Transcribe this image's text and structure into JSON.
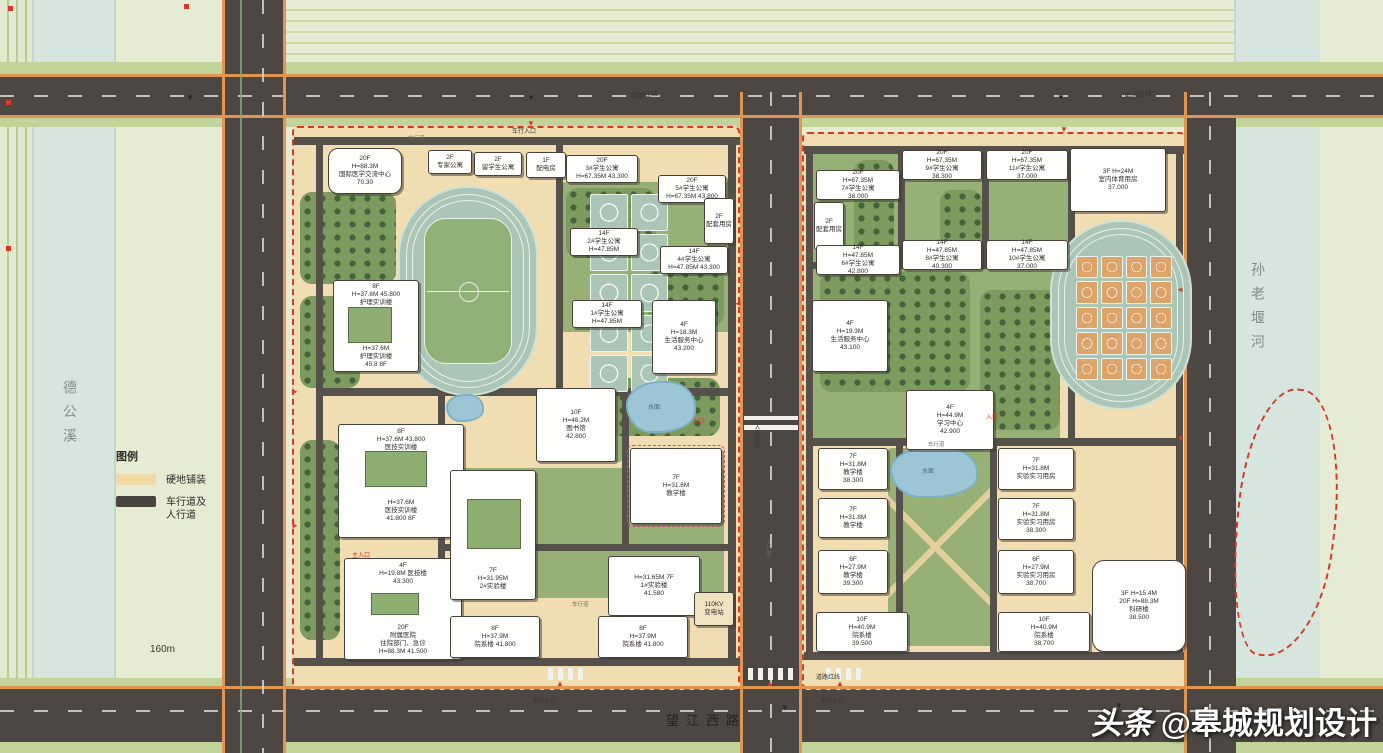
{
  "watermark": {
    "brand": "头条",
    "handle": "@皋城规划设计"
  },
  "legend": {
    "title": "图例",
    "items": [
      {
        "label": "硬地铺装",
        "swatch": "#f2d9a8"
      },
      {
        "label": "车行道及\n人行道",
        "swatch": "#4a443f"
      }
    ]
  },
  "rivers": {
    "west": "德公溪",
    "east": "孙老堰河"
  },
  "roads": {
    "south_name": "望江西路",
    "scale": "160m",
    "boundary_line": "用地红线",
    "road_red_line": "道路红线",
    "lane": "车行道",
    "walk": "人行道"
  },
  "labels": {
    "water": "水面",
    "entrance": "入口",
    "main_entrance": "主入口",
    "vehicle_entrance": "车行入口",
    "footbridge": "人行连廊"
  },
  "campus_west": {
    "buildings": [
      {
        "lines": [
          "20F",
          "H=88.3M",
          "国际医学交流中心",
          "70.30"
        ]
      },
      {
        "lines": [
          "2F",
          "专家公寓"
        ]
      },
      {
        "lines": [
          "2F",
          "留学生公寓"
        ]
      },
      {
        "lines": [
          "1F",
          "配电房"
        ]
      },
      {
        "lines": [
          "20F",
          "3#学生公寓",
          "H=67.35M  43.300"
        ]
      },
      {
        "lines": [
          "20F",
          "5#学生公寓",
          "H=67.35M  43.800"
        ]
      },
      {
        "lines": [
          "2F",
          "配套用房"
        ]
      },
      {
        "lines": [
          "14F",
          "2#学生公寓",
          "H=47.85M"
        ]
      },
      {
        "lines": [
          "14F",
          "4#学生公寓",
          "H=47.85M  43.300"
        ]
      },
      {
        "lines": [
          "14F",
          "1#学生公寓",
          "H=47.85M"
        ]
      },
      {
        "lines": [
          "4F",
          "H=18.3M",
          "生活服务中心",
          "43.200"
        ]
      },
      {
        "lines": [
          "8F",
          "H=37.6M  45.800",
          "护理实训楼"
        ]
      },
      {
        "lines": [
          "H=37.6M",
          "护理实训楼",
          "45.8  8F"
        ]
      },
      {
        "lines": [
          "8F",
          "H=37.6M  43.800",
          "医技实训楼"
        ]
      },
      {
        "lines": [
          "H=37.6M",
          "医技实训楼",
          "41.800  8F"
        ]
      },
      {
        "lines": [
          "4F",
          "H=19.8M  医技楼",
          "43.300"
        ]
      },
      {
        "lines": [
          "20F",
          "附属医院",
          "住院部门、急诊",
          "H=88.3M  41.500"
        ]
      },
      {
        "lines": [
          "10F",
          "H=46.2M",
          "图书馆",
          "42.800"
        ]
      },
      {
        "lines": [
          "7F",
          "H=31.6M",
          "教学楼"
        ]
      },
      {
        "lines": [
          "7F",
          "H=31.95M",
          "2#实验楼"
        ]
      },
      {
        "lines": [
          "H=31.65M  7F",
          "1#实验楼",
          "41.580"
        ]
      },
      {
        "lines": [
          "8F",
          "H=37.9M",
          "院系楼  41.800"
        ]
      },
      {
        "lines": [
          "8F",
          "H=37.9M",
          "院系楼  41.800"
        ]
      },
      {
        "lines": [
          "110KV",
          "变电站"
        ]
      }
    ]
  },
  "campus_east": {
    "buildings": [
      {
        "lines": [
          "20F",
          "H=67.35M",
          "7#学生公寓",
          "38.000"
        ]
      },
      {
        "lines": [
          "20F",
          "H=67.35M",
          "9#学生公寓",
          "38.300"
        ]
      },
      {
        "lines": [
          "20F",
          "H=67.35M",
          "11#学生公寓",
          "37.000"
        ]
      },
      {
        "lines": [
          "2F",
          "配套用房"
        ]
      },
      {
        "lines": [
          "14F",
          "H=47.85M",
          "6#学生公寓",
          "42.800"
        ]
      },
      {
        "lines": [
          "14F",
          "H=47.85M",
          "8#学生公寓",
          "40.300"
        ]
      },
      {
        "lines": [
          "14F",
          "H=47.85M",
          "10#学生公寓",
          "37.000"
        ]
      },
      {
        "lines": [
          "3F  H=24M",
          "室内体育用房",
          "37.000"
        ]
      },
      {
        "lines": [
          "4F",
          "H=19.3M",
          "生活服务中心",
          "43.100"
        ]
      },
      {
        "lines": [
          "4F",
          "H=44.9M",
          "学习中心",
          "42.900"
        ]
      },
      {
        "lines": [
          "7F",
          "H=31.8M",
          "教学楼",
          "38.300"
        ]
      },
      {
        "lines": [
          "7F",
          "H=31.8M",
          "实验实习用房"
        ]
      },
      {
        "lines": [
          "7F",
          "H=31.8M",
          "教学楼"
        ]
      },
      {
        "lines": [
          "7F",
          "H=31.8M",
          "实验实习用房",
          "38.300"
        ]
      },
      {
        "lines": [
          "6F",
          "H=27.9M",
          "教学楼",
          "39.300"
        ]
      },
      {
        "lines": [
          "6F",
          "H=27.9M",
          "实验实习用房",
          "38.700"
        ]
      },
      {
        "lines": [
          "10F",
          "H=40.9M",
          "院系楼",
          "39.500"
        ]
      },
      {
        "lines": [
          "10F",
          "H=40.9M",
          "院系楼",
          "38.700"
        ]
      },
      {
        "lines": [
          "3F  H=15.4M",
          "20F  H=88.3M",
          "科研楼",
          "38.500"
        ]
      }
    ]
  }
}
